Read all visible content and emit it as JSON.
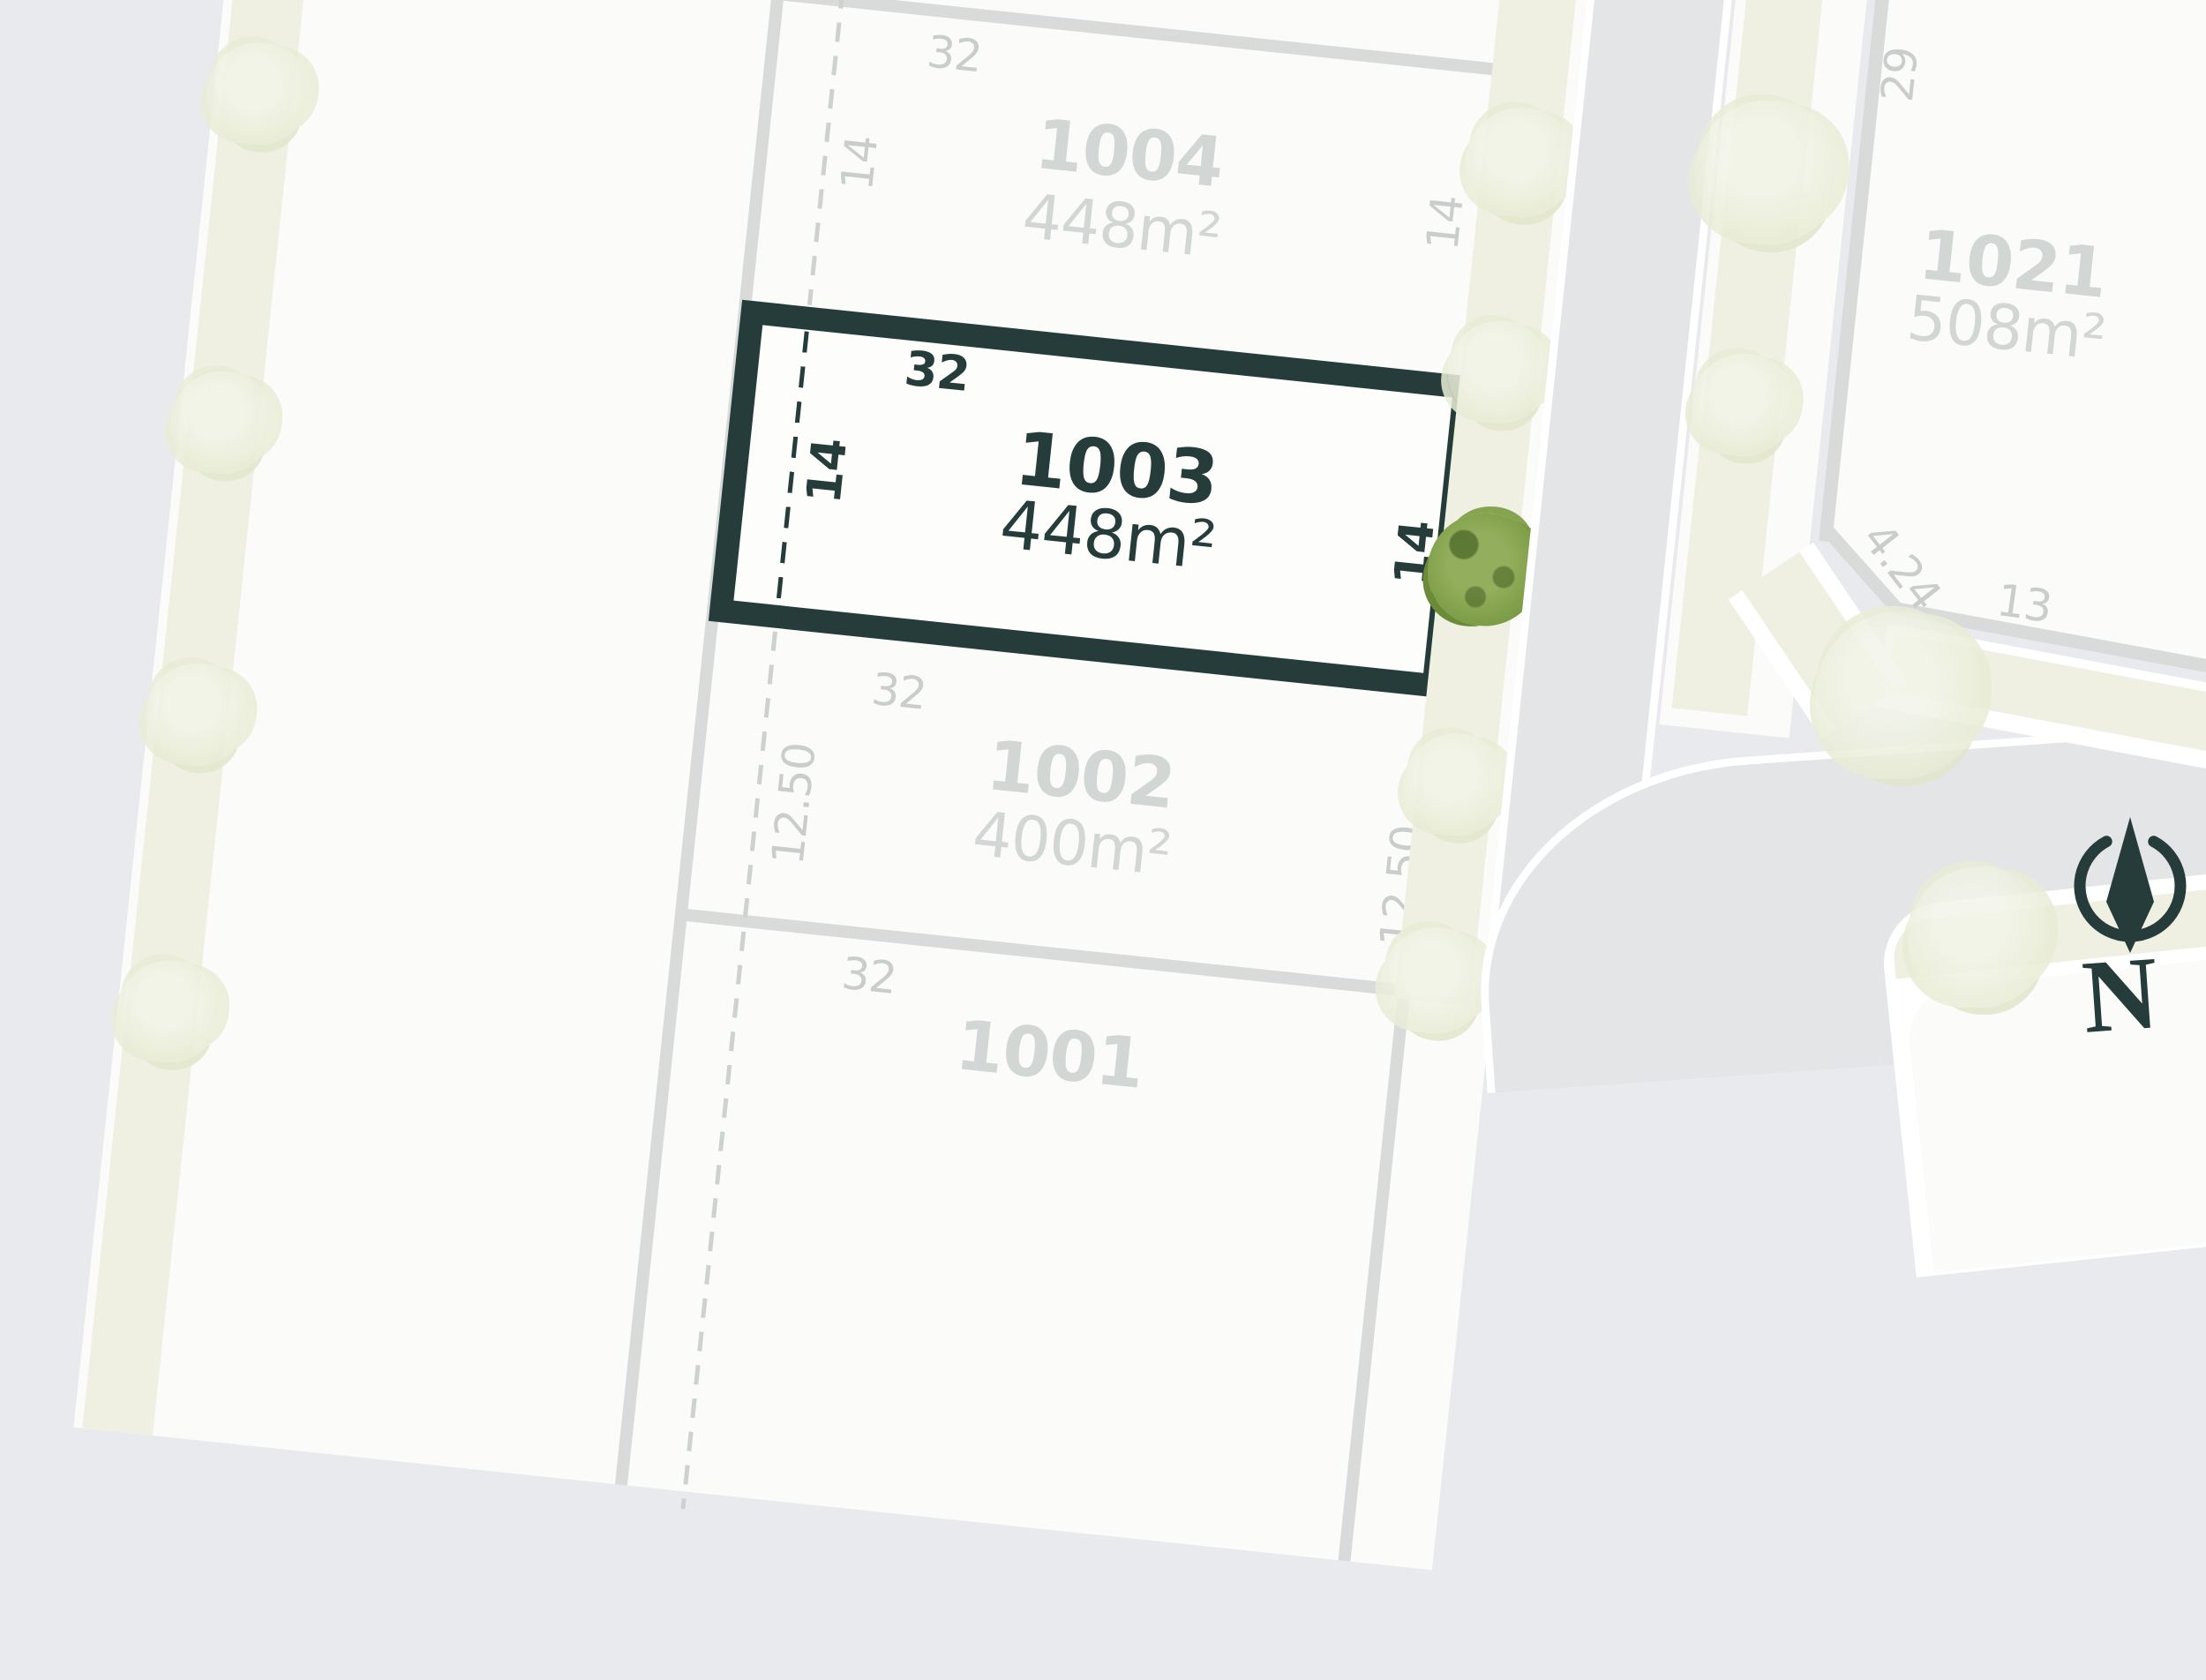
{
  "map_title": "residential estate lot map",
  "lots": [
    {
      "id": "1004",
      "area": "448m²",
      "dim_top": "32",
      "dim_left": "14",
      "dim_right": "14",
      "highlighted": false
    },
    {
      "id": "1003",
      "area": "448m²",
      "dim_top": "32",
      "dim_left": "14",
      "dim_right": "14",
      "highlighted": true
    },
    {
      "id": "1002",
      "area": "400m²",
      "dim_top": "32",
      "dim_left": "12.50",
      "dim_right": "12.50",
      "highlighted": false
    },
    {
      "id": "1001",
      "dim_top": "32",
      "highlighted": false
    },
    {
      "id": "1021",
      "area": "508m²",
      "dim_side": "29",
      "dim_bevel": "4.24",
      "dim_bottom": "13",
      "highlighted": false
    }
  ],
  "compass": {
    "label": "N"
  },
  "colors": {
    "dark": "#253c3a",
    "muted": "#d2d6d5",
    "dim": "#c9cecd",
    "boundary": "#d8dbda",
    "white-lot": "#fbfbfa",
    "hl-fill": "#fdfdfc",
    "beige": "#eff0e1",
    "road": "#e4e5e7",
    "base": "#e9eaed",
    "tree-faded": "#e9edd6",
    "tree-green": "#7a9a44",
    "dash-gray": "#cdd2d1"
  }
}
